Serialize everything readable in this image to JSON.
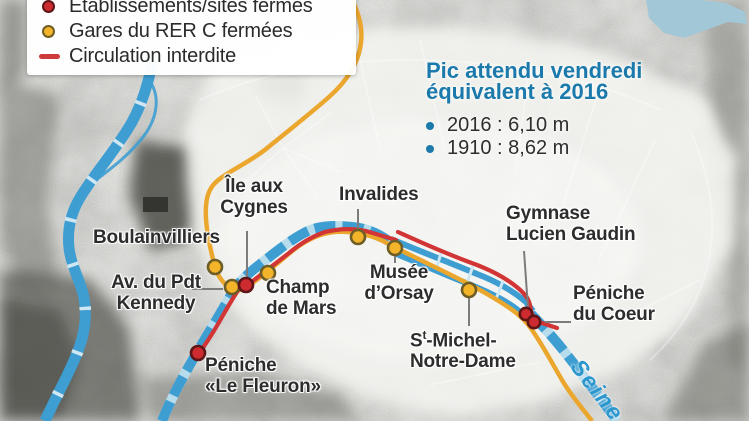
{
  "legend": {
    "items": [
      {
        "marker": "red-dot",
        "label": "Établissements/sites fermés"
      },
      {
        "marker": "yellow-dot",
        "label": "Gares du RER C fermées"
      },
      {
        "marker": "red-line",
        "label": "Circulation interdite"
      }
    ]
  },
  "infobox": {
    "title_line1": "Pic attendu vendredi",
    "title_line2": "équivalent à 2016",
    "bullets": [
      "2016 : 6,10 m",
      "1910 : 8,62 m"
    ]
  },
  "map_labels": {
    "boulainvilliers": "Boulainvilliers",
    "invalides": "Invalides",
    "ile_aux_cygnes": {
      "line1": "Île aux",
      "line2": "Cygnes"
    },
    "av_pdt_kennedy": {
      "line1": "Av. du Pdt",
      "line2": "Kennedy"
    },
    "champ_de_mars": {
      "line1": "Champ",
      "line2": "de Mars"
    },
    "musee_orsay": {
      "line1": "Musée",
      "line2": "d’Orsay"
    },
    "gymnase_lucien_gaudin": {
      "line1": "Gymnase",
      "line2": "Lucien Gaudin"
    },
    "peniche_du_coeur": {
      "line1": "Péniche",
      "line2": "du Coeur"
    },
    "st_michel_notre_dame": {
      "prefix": "S",
      "sup": "t",
      "line1_rest": "-Michel-",
      "line2": "Notre-Dame"
    },
    "peniche_le_fleuron": {
      "line1": "Péniche",
      "line2": "«Le Fleuron»"
    },
    "seine": "Seine"
  },
  "colors": {
    "accent_blue": "#1b7aab",
    "river_blue": "#3e9ed2",
    "river_gap_blue": "#cfe7f3",
    "rer_c_orange": "#eba72d",
    "closed_red": "#d23535",
    "dot_yellow": "#f4b42a",
    "dot_red": "#ce2b30",
    "label_dark": "#2d2d2d",
    "seine_label_blue": "#2b97cd",
    "lake_blue": "#a2c8d8"
  }
}
